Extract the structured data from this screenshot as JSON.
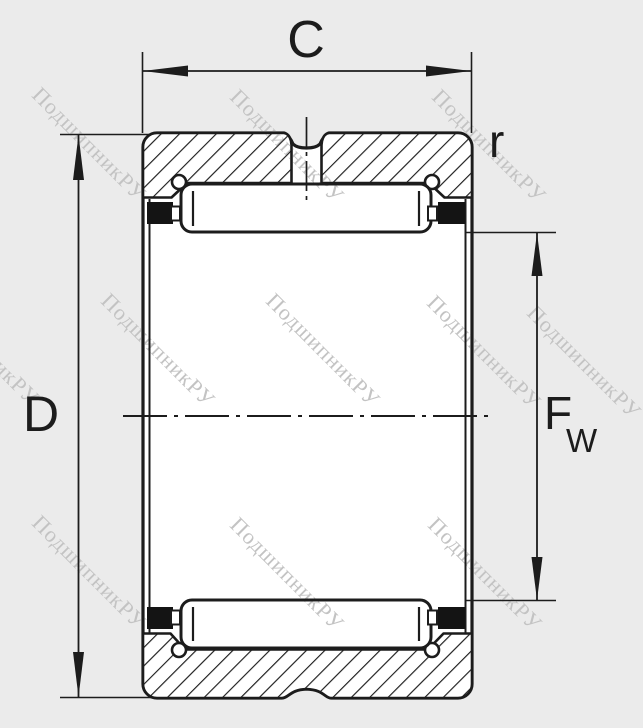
{
  "title": "Needle roller bearing cross-section drawing",
  "labels": {
    "width": "C",
    "corner_radius": "r",
    "outer_diameter": "D",
    "bore_main": "F",
    "bore_sub": "W"
  },
  "watermark": {
    "text": "ПодшипникРУ"
  },
  "colors": {
    "background": "#ebebeb",
    "line": "#1c1c1c",
    "fill_white": "#ffffff",
    "seal_black": "#141414",
    "watermark_gray": "#c3c3c3"
  }
}
